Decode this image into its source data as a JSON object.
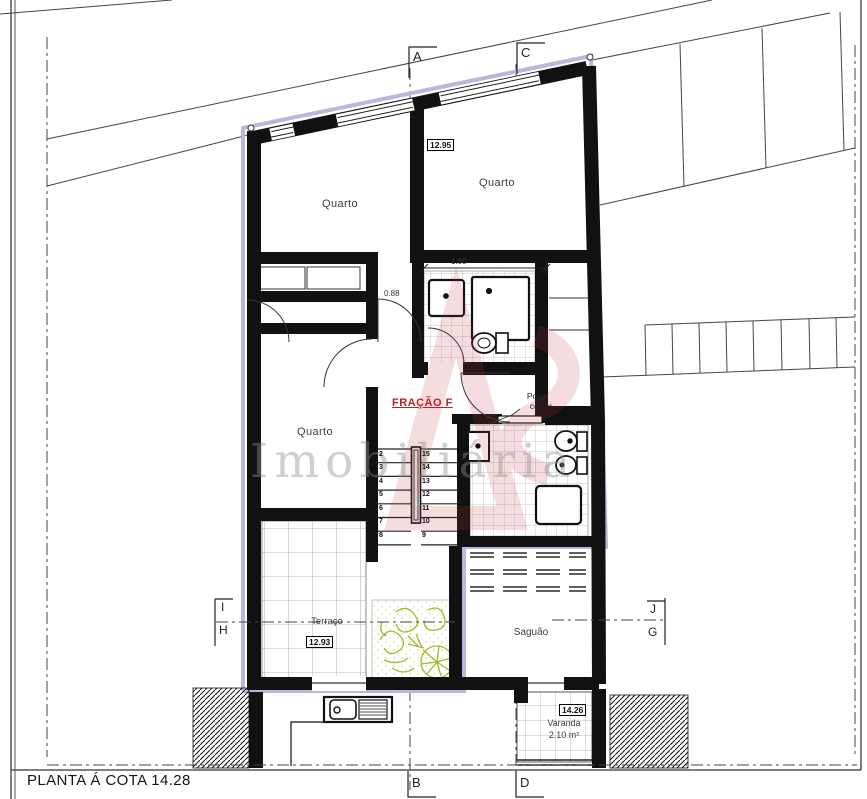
{
  "title": "PLANTA Á COTA 14.28",
  "fraction_label": "FRAÇÃO F",
  "watermark": {
    "text": "Imobiliária",
    "logo": "AS"
  },
  "rooms": {
    "quarto_top_left": "Quarto",
    "quarto_top_right": "Quarto",
    "quarto_mid_left": "Quarto",
    "terraco": "Terraço",
    "saguao": "Saguão",
    "varanda": "Varanda",
    "varanda_area": "2.10 m²"
  },
  "dimensions": {
    "level_top": "12.95",
    "level_terraco": "12.93",
    "level_varanda": "14.26",
    "bath_width": "1.80",
    "door_width": "0.88"
  },
  "doors": {
    "sliding_label_1": "Porta",
    "sliding_label_2": "correr"
  },
  "section_markers": {
    "a": "A",
    "b": "B",
    "c": "C",
    "d": "D",
    "i": "I",
    "h": "H",
    "j": "J",
    "g": "G"
  },
  "stairs": {
    "left_numbers": [
      "2",
      "3",
      "4",
      "5",
      "6",
      "7",
      "8"
    ],
    "right_numbers": [
      "15",
      "14",
      "13",
      "12",
      "11",
      "10",
      "9"
    ]
  },
  "colors": {
    "boundary_lavender": "#b9b7dc",
    "fraction_red": "#c41f1f",
    "vegetation_green": "#9cbb2c",
    "watermark_red": "#c8323c",
    "watermark_gray": "#8f8f8f",
    "wall_black": "#111111"
  }
}
